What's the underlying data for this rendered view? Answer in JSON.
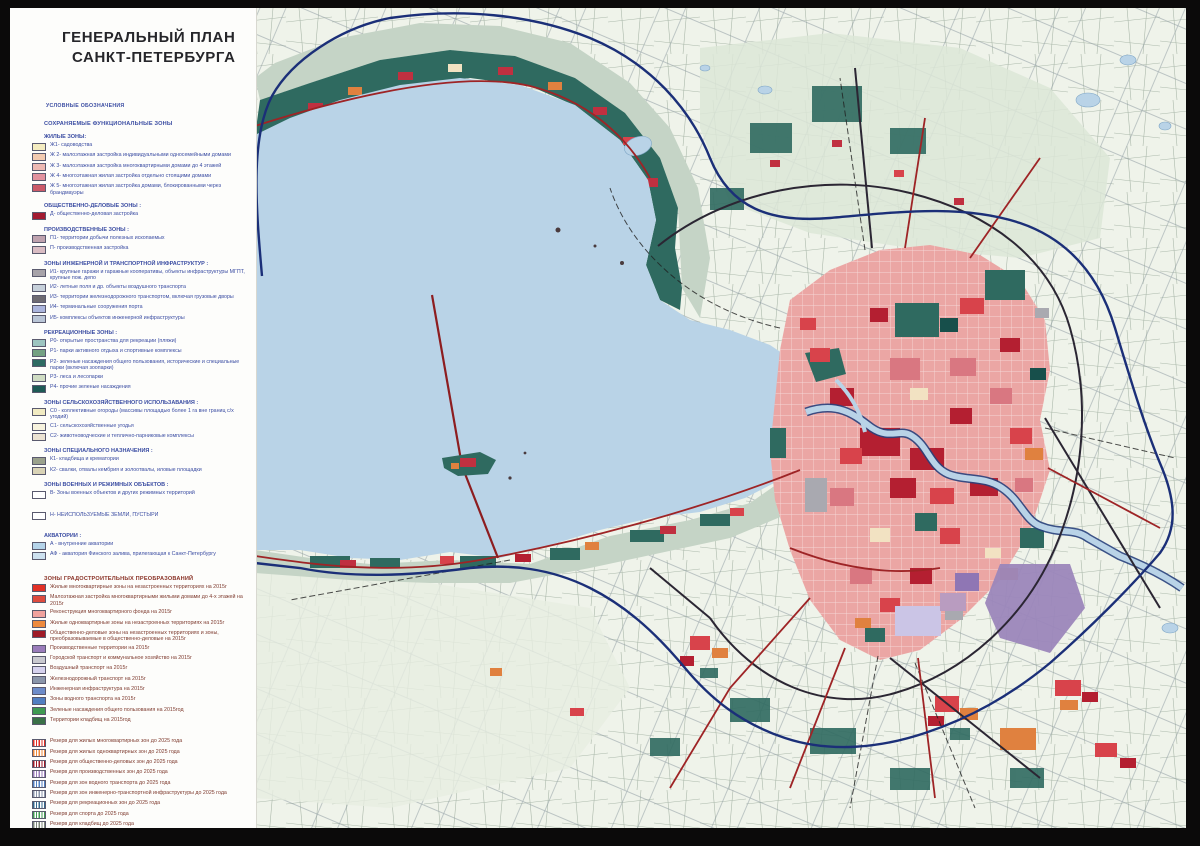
{
  "title": {
    "line1": "ГЕНЕРАЛЬНЫЙ ПЛАН",
    "line2": "САНКТ-ПЕТЕРБУРГА"
  },
  "legend": {
    "caption": "УСЛОВНЫЕ ОБОЗНАЧЕНИЯ",
    "section1_title": "СОХРАНЯЕМЫЕ ФУНКЦИОНАЛЬНЫЕ ЗОНЫ",
    "groups": [
      {
        "title": "ЖИЛЫЕ ЗОНЫ:",
        "items": [
          {
            "swatch": "#f4ecc0",
            "label": "Ж1- садоводства"
          },
          {
            "swatch": "#f3cbb0",
            "label": "Ж 2- малоэтажная застройка индивидуальными односемейными домами"
          },
          {
            "swatch": "#eeb9b2",
            "label": "Ж 3- малоэтажная застройка многоквартирными домами до 4 этажей"
          },
          {
            "swatch": "#e2929e",
            "label": "Ж 4- многоэтажная жилая застройка отдельно стоящими домами"
          },
          {
            "swatch": "#cb5968",
            "label": "Ж 5- многоэтажная жилая застройка домами, блокированными через брандмауэры"
          }
        ]
      },
      {
        "title": "ОБЩЕСТВЕННО-ДЕЛОВЫЕ ЗОНЫ :",
        "items": [
          {
            "swatch": "#a31b31",
            "label": "Д- общественно-деловая застройка"
          }
        ]
      },
      {
        "title": "ПРОИЗВОДСТВЕННЫЕ ЗОНЫ :",
        "items": [
          {
            "swatch": "#bfa2ae",
            "label": "П1- территории добычи полезных ископаемых"
          },
          {
            "swatch": "#d9bcc3",
            "label": "П- производственная застройка"
          }
        ]
      },
      {
        "title": "ЗОНЫ ИНЖЕНЕРНОЙ И ТРАНСПОРТНОЙ  ИНФРАСТРУКТУР :",
        "items": [
          {
            "swatch": "#a7a3a9",
            "label": "И1- крупные гаражи и гаражные кооперативы, объекты инфраструктуры МГПТ, крупные пож. депо"
          },
          {
            "swatch": "#c6d0da",
            "label": "И2- летные поля  и др. объекты воздушного транспорта"
          },
          {
            "swatch": "#6e6b72",
            "label": "И3- территории железнодорожного транспортом, включая грузовые дворы"
          },
          {
            "swatch": "#abb5dd",
            "label": "И4- терминальные сооружения порта"
          },
          {
            "swatch": "#b9c5d6",
            "label": "И5- комплексы объектов инженерной инфраструктуры"
          }
        ]
      },
      {
        "title": "РЕКРЕАЦИОННЫЕ ЗОНЫ :",
        "items": [
          {
            "swatch": "#9dc5c0",
            "label": "Р0- открытые пространства для рекреации (пляжи)"
          },
          {
            "swatch": "#74a182",
            "label": "Р1- парки активного отдыха и спортивные комплексы"
          },
          {
            "swatch": "#2e6b63",
            "label": "Р2- зеленые насаждения общего пользования, исторические и специальные парки (включая зоопарки)"
          },
          {
            "swatch": "#cfdcc3",
            "label": "Р3- леса и лесопарки"
          },
          {
            "swatch": "#1e5a55",
            "label": "Р4- прочие зеленые насаждения"
          }
        ]
      },
      {
        "title": "ЗОНЫ СЕЛЬСКОХОЗЯЙСТВЕННОГО ИСПОЛЬЗАВАНИЯ :",
        "items": [
          {
            "swatch": "#f1ebc2",
            "label": "С0 - коллективные огороды (массивы площадью более 1 га вне границ с/х угодий)"
          },
          {
            "swatch": "#f7f3de",
            "label": "С1- сельскохозяйственные угодья"
          },
          {
            "swatch": "#ece3d2",
            "label": "С2- животноводческие и теплично-парниковые комплексы"
          }
        ]
      },
      {
        "title": "ЗОНЫ СПЕЦИАЛЬНОГО НАЗНАЧЕНИЯ :",
        "items": [
          {
            "swatch": "#9aa18c",
            "label": "К1- кладбища и крематории"
          },
          {
            "swatch": "#d9d3b6",
            "label": "К2- свалки, отвалы кембрия и золоотвалы, иловые площадки"
          }
        ]
      },
      {
        "title": "ЗОНЫ ВОЕННЫХ И РЕЖИМНЫХ ОБЪЕКТОВ :",
        "items": [
          {
            "swatch": "#ffffff",
            "label": "В- Зоны военных объектов и других режимных территорий"
          }
        ]
      },
      {
        "title": "",
        "gap": true,
        "items": [
          {
            "swatch": "#ffffff",
            "label": "Н- НЕИСПОЛЬЗУЕМЫЕ ЗЕМЛИ, ПУСТЫРИ"
          }
        ]
      },
      {
        "title": "АКВАТОРИИ :",
        "gap": true,
        "items": [
          {
            "swatch": "#b5d4e9",
            "label": "А - внутренние акватории"
          },
          {
            "swatch": "#cde1ef",
            "label": "АФ - акватория Финского залива, прилегающая к Санкт-Петербургу"
          }
        ]
      }
    ],
    "section2_title": "ЗОНЫ ГРАДОСТРОИТЕЛЬНЫХ ПРЕОБРАЗОВАНИЙ",
    "transform_items": [
      {
        "swatch": "#e23126",
        "label": "Жилые многоквартирные зоны на незастроенных территориях на 2015г"
      },
      {
        "swatch": "#de4b3e",
        "label": "Малоэтажная застройка многоквартирными жилыми домами до 4-х этажей на 2015г"
      },
      {
        "swatch": "#f0a29e",
        "label": "Реконструкция  многоквартирного фонда на 2015г"
      },
      {
        "swatch": "#ee8a3e",
        "label": "Жилые одноквартирные зоны на незастроенных территориях на 2015г"
      },
      {
        "swatch": "#9e1b28",
        "label": "Общественно-деловые зоны на незастроенных территориях и зоны, преобразовываемые в общественно-деловые на 2015г"
      },
      {
        "swatch": "#9a7cba",
        "label": "Производственные территории на 2015г"
      },
      {
        "swatch": "#c9c9cf",
        "label": "Городской транспорт и коммунальное хозяйство на 2015г"
      },
      {
        "swatch": "#d6d2ee",
        "label": "Воздушный транспорт на 2015г"
      },
      {
        "swatch": "#8a96aa",
        "label": "Железнодорожный транспорт на 2015г"
      },
      {
        "swatch": "#6d8cc9",
        "label": "Инженерная инфраструктура на 2015г"
      },
      {
        "swatch": "#517fc1",
        "label": "Зоны водного транспорта на 2015г"
      },
      {
        "swatch": "#3f9a52",
        "label": "Зеленые насаждения общего пользования на 2015год"
      },
      {
        "swatch": "#3a7148",
        "label": "Территории кладбищ на 2015год"
      }
    ],
    "reserve_items": [
      {
        "swatch": "#e23126",
        "hatch": true,
        "label": "Резерв  для жилых многоквартирных зон до 2025 года"
      },
      {
        "swatch": "#ee8a3e",
        "hatch": true,
        "label": "Резерв  для жилых одноквартирных зон до 2025 года"
      },
      {
        "swatch": "#9e1b28",
        "hatch": true,
        "label": "Резерв  для общественно-деловых зон до 2025 года"
      },
      {
        "swatch": "#9a7cba",
        "hatch": true,
        "label": "Резерв  для производственных зон до 2025 года"
      },
      {
        "swatch": "#517fc1",
        "hatch": true,
        "label": "Резерв  для зон водного транспорта до 2025 года"
      },
      {
        "swatch": "#8a96aa",
        "hatch": true,
        "label": "Резерв  для зон инженерно-транспортной инфраструктуры до 2025 года"
      },
      {
        "swatch": "#33688c",
        "hatch": true,
        "label": "Резерв для рекреационных зон до 2025 года"
      },
      {
        "swatch": "#3f9a52",
        "hatch": true,
        "label": "Резерв для спорта до 2025 года"
      },
      {
        "swatch": "#7c8878",
        "hatch": true,
        "label": "Резерв для кладбищ до 2025 года"
      }
    ]
  },
  "map": {
    "palette": {
      "gulf_water": "#b9d3e7",
      "inner_water": "#b5d4e9",
      "forest_teal": "#2f6a60",
      "forest_dark": "#174f4b",
      "sage_green": "#c5d4c6",
      "pale_land": "#eff3ea",
      "city_pink": "#eba6a4",
      "crimson": "#b41f31",
      "red": "#d8434b",
      "rose": "#d97781",
      "orange": "#e0813f",
      "cream": "#f2e2c2",
      "purple": "#9b86bb",
      "lavender": "#cbc5e6",
      "gray": "#a9a9b0",
      "city_boundary": "#1b2f78",
      "main_road_red": "#9e2426",
      "main_road_dark": "#2b2633"
    }
  }
}
